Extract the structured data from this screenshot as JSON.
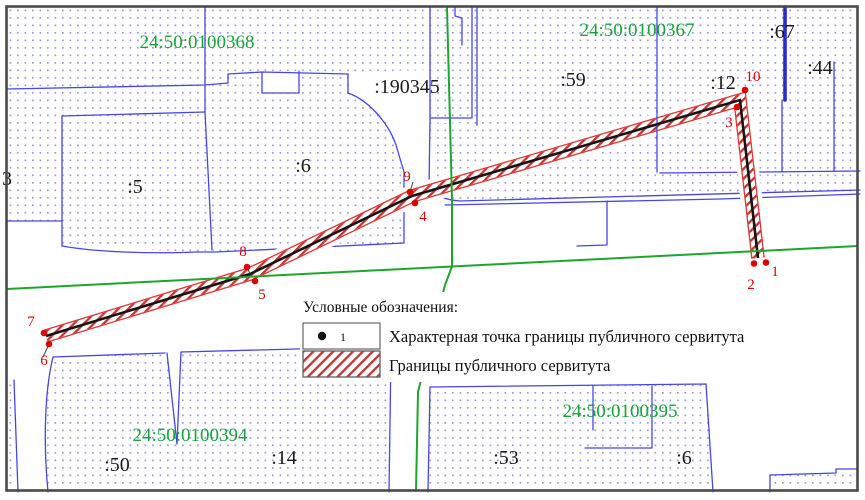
{
  "map": {
    "quarters": [
      {
        "label": "24:50:0100368"
      },
      {
        "label": "24:50:0100367"
      },
      {
        "label": "24:50:0100394"
      },
      {
        "label": "24:50:0100395"
      }
    ],
    "parcels": [
      {
        "label": "3"
      },
      {
        "label": ":5"
      },
      {
        "label": ":6"
      },
      {
        "label": ":190345"
      },
      {
        "label": ":59"
      },
      {
        "label": ":12"
      },
      {
        "label": ":67"
      },
      {
        "label": ":44"
      },
      {
        "label": ":50"
      },
      {
        "label": ":14"
      },
      {
        "label": ":53"
      },
      {
        "label": ":6"
      }
    ],
    "points": [
      {
        "n": "1"
      },
      {
        "n": "2"
      },
      {
        "n": "3"
      },
      {
        "n": "4"
      },
      {
        "n": "5"
      },
      {
        "n": "6"
      },
      {
        "n": "7"
      },
      {
        "n": "8"
      },
      {
        "n": "9"
      },
      {
        "n": "10"
      }
    ],
    "legend": {
      "title": "Условные обозначения:",
      "point_symbol_label": "1",
      "items": [
        {
          "label": "Характерная точка границы публичного сервитута"
        },
        {
          "label": "Границы публичного сервитута"
        }
      ]
    },
    "colors": {
      "parcel_line_blue": "#4646e2",
      "parcel_dot_fill": "#9898ee",
      "quarter_label_green": "#18a338",
      "boundary_green": "#1ea52e",
      "servitude_edge_red": "#e23333",
      "servitude_hatch_red": "#c03434",
      "point_red": "#dd0000",
      "centerline_black": "#151515",
      "map_border_gray": "#4a4a4a"
    }
  }
}
